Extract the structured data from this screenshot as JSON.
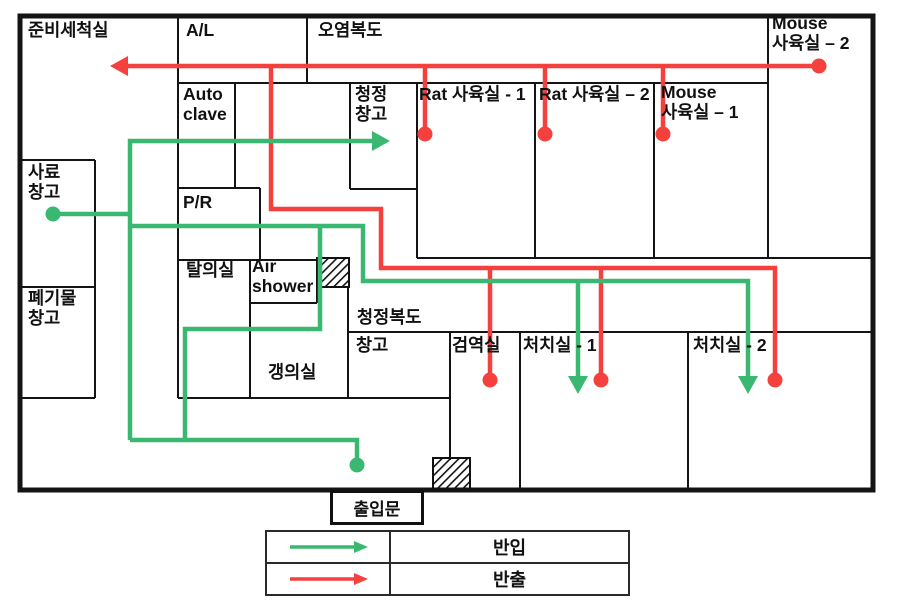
{
  "colors": {
    "carry_in": "#3ab871",
    "carry_out": "#f5413d",
    "wall": "#141414"
  },
  "rooms": {
    "prep_wash": "준비세척실",
    "air_lock": "A/L",
    "dirty_corridor": "오염복도",
    "mouse_room_2": "Mouse 사육실 – 2",
    "autoclave": "Auto clave",
    "clean_storage": "청정 창고",
    "rat_room_1": "Rat 사육실 - 1",
    "rat_room_2": "Rat 사육실 – 2",
    "mouse_room_1": "Mouse 사육실 – 1",
    "feed_storage": "사료 창고",
    "pass_room": "P/R",
    "undressing_room": "탈의실",
    "air_shower": "Air shower",
    "waste_storage": "폐기물 창고",
    "clean_corridor": "청정복도",
    "storage": "창고",
    "quarantine_room": "검역실",
    "treatment_room_1": "처치실 - 1",
    "treatment_room_2": "처치실 - 2",
    "dressing_room": "갱의실"
  },
  "entrance": {
    "label": "출입문"
  },
  "legend": {
    "carry_in_label": "반입",
    "carry_out_label": "반출"
  }
}
